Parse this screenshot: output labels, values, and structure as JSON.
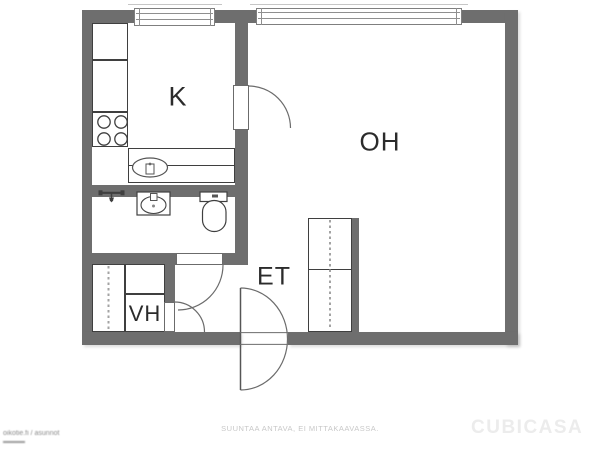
{
  "floorplan": {
    "rooms": {
      "kitchen": {
        "label": "K",
        "fixtures": [
          "cabinets",
          "stove",
          "sink-counter"
        ]
      },
      "living_room": {
        "label": "OH",
        "fixtures": [
          "wardrobe"
        ]
      },
      "entry": {
        "label": "ET",
        "fixtures": [
          "entrance-door"
        ]
      },
      "closet": {
        "label": "VH",
        "fixtures": [
          "wardrobe",
          "cabinet"
        ]
      },
      "bathroom": {
        "fixtures": [
          "shower",
          "washbasin",
          "toilet"
        ]
      }
    },
    "icons": {
      "stove": "stove-burners-icon",
      "kitchen_sink": "kitchen-sink-icon",
      "shower": "shower-icon",
      "washbasin": "washbasin-icon",
      "toilet": "toilet-icon",
      "wardrobe": "wardrobe-dashed-icon",
      "doors": [
        "kitchen-door-arc",
        "bathroom-door-arc",
        "closet-door-arc",
        "entrance-door-arc"
      ],
      "windows": [
        "window-kitchen",
        "window-living-room"
      ]
    },
    "footer": {
      "disclaimer": "SUUNTAA ANTAVA, EI MITTAKAAVASSA.",
      "brand": "CUBICASA",
      "watermark": "oikotie.fi / asunnot"
    },
    "colors": {
      "wall": "#6e6e6e",
      "floor": "#ffffff",
      "line": "#3f3f3f",
      "door": "#6b6b6b",
      "label": "#2b2b2b",
      "dash": "#a3a3a3",
      "disclaimer": "#c8c8c8",
      "brand": "#ececec",
      "watermark": "#8a8a8a"
    }
  }
}
